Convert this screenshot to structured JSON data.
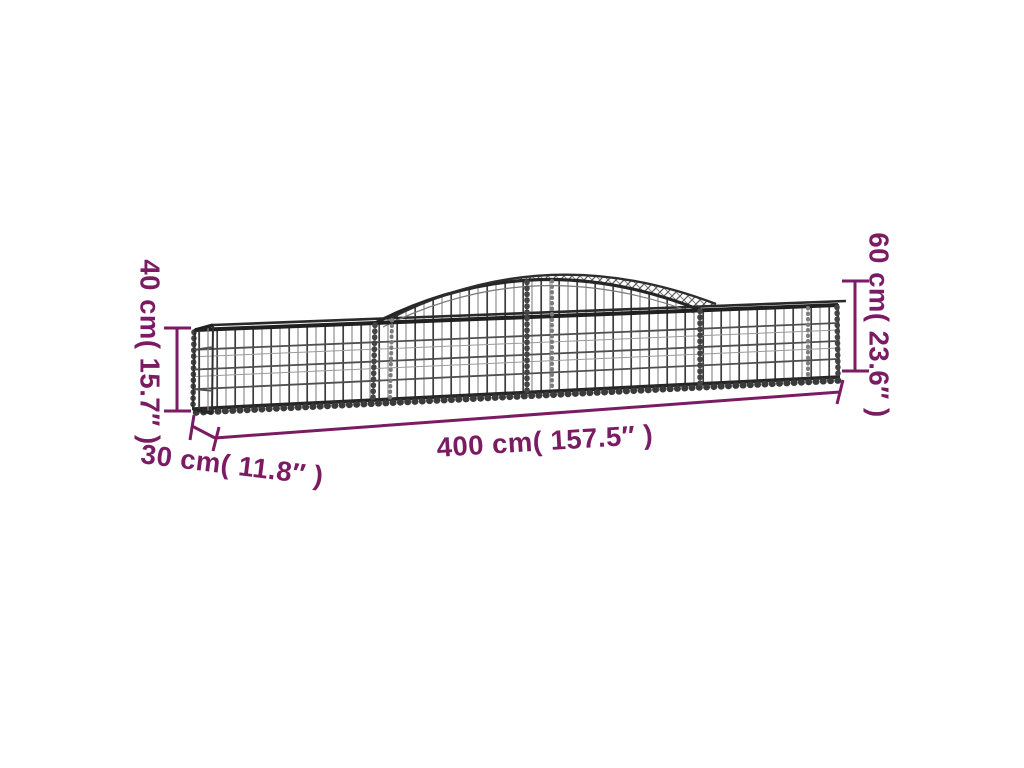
{
  "figure": {
    "subject_label": "arched gabion mesh basket dimension diagram"
  },
  "colors": {
    "accent": "#7A1B63",
    "wire_dark": "#2e2e2e",
    "wire_mid": "#5a5a5a",
    "wire_light": "#8f8f8f",
    "background": "#ffffff"
  },
  "annotations": {
    "height_left": "40 cm( 15.7″ )",
    "height_right": "60 cm( 23.6″ )",
    "length_bottom": "400 cm( 157.5″ )",
    "depth_bottom_left": "30 cm( 11.8″ )"
  }
}
